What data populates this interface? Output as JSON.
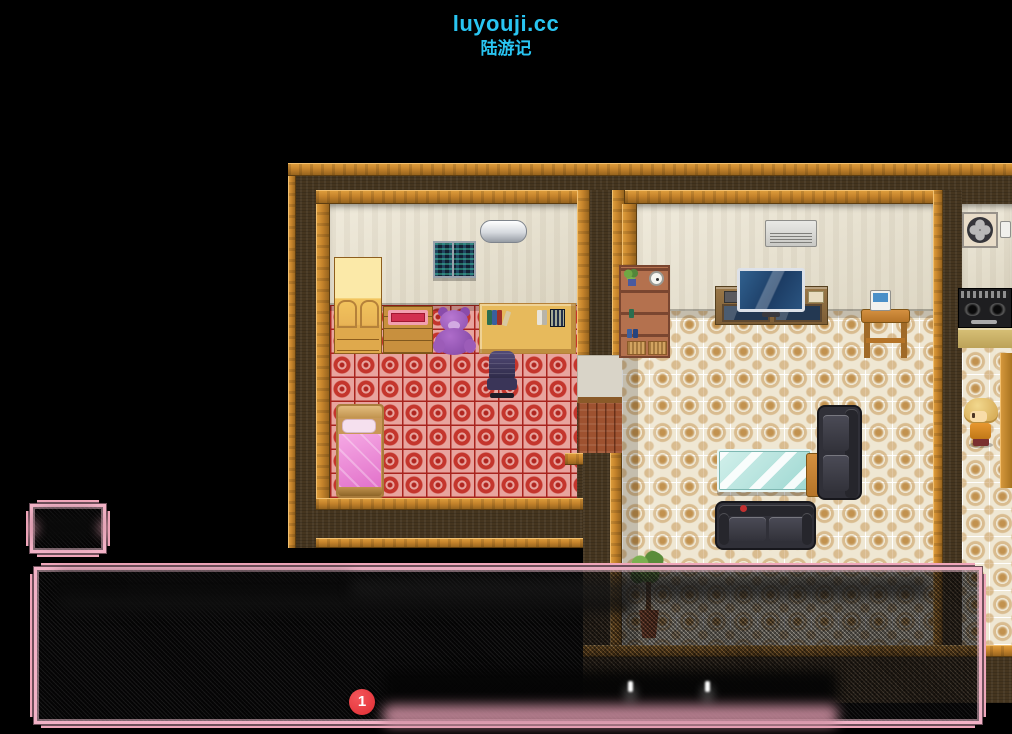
{
  "header": {
    "site": "luyouji.cc",
    "game_title": "陆游记",
    "color": "#29C5F2"
  },
  "hud": {
    "notification_badge": {
      "value": "1",
      "color": "#E8383C"
    }
  },
  "dialogue": {
    "window_skin_color": "#F2ABBE",
    "name_box_state": "blurred",
    "text_state": "blurred"
  },
  "scene": {
    "type": "rpg-interior",
    "rooms": [
      "bedroom",
      "living-room",
      "kitchen"
    ],
    "objects": [
      "window-night-city",
      "air-conditioner",
      "wardrobe",
      "dresser",
      "red-tray",
      "teddy-bear",
      "desk",
      "books",
      "office-chair",
      "bed",
      "bookshelf",
      "plant-small",
      "wall-clock",
      "tv",
      "tv-stand",
      "phone",
      "phone-table",
      "glass-coffee-table",
      "side-table",
      "armchair",
      "couch",
      "potted-plant",
      "exhaust-fan",
      "power-plug",
      "gas-stove",
      "kitchen-counter",
      "gold-door",
      "door-mat",
      "wood-doorway",
      "npc-blonde"
    ],
    "palette": {
      "outer_wall": "#45351F",
      "trim": "#C5832B",
      "inner_wall": "#EAE3CF",
      "tile_floor": "#EFE7D3",
      "tile_accent": "#C2924F",
      "carpet": "#C4352C",
      "carpet_bg": "#E8A49E"
    }
  }
}
